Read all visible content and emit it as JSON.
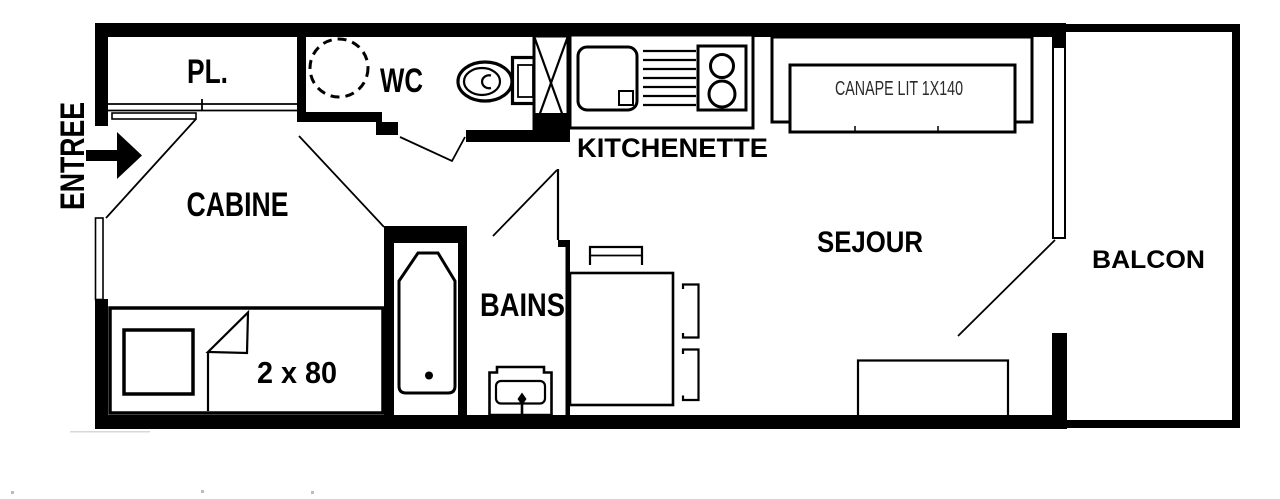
{
  "colors": {
    "ink": "#000000",
    "paper": "#ffffff",
    "sofa_label_ink": "#2b2b2b"
  },
  "rooms": {
    "entree": {
      "label": "ENTREE"
    },
    "pl": {
      "label": "PL."
    },
    "wc": {
      "label": "WC"
    },
    "kitchenette": {
      "label": "KITCHENETTE"
    },
    "cabine": {
      "label": "CABINE"
    },
    "bains": {
      "label": "BAINS"
    },
    "sejour": {
      "label": "SEJOUR"
    },
    "balcon": {
      "label": "BALCON"
    }
  },
  "furniture": {
    "sofa_bed": {
      "label": "CANAPE LIT 1X140"
    },
    "bunk_bed": {
      "label": "2 x 80"
    }
  }
}
